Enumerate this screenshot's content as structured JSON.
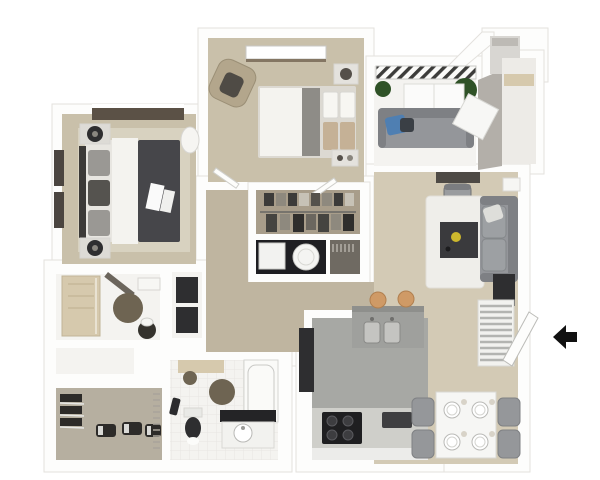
{
  "meta": {
    "type": "3d-floor-plan-rendering",
    "view": "top-down isometric",
    "canvas": {
      "width": 600,
      "height": 480
    },
    "visible_text": "none"
  },
  "colors": {
    "wall": "#fdfdfc",
    "wallEdge": "#e3e1dd",
    "grayWall": "#b3afa9",
    "floorTan": "#c9c0aa",
    "floorTanLight": "#d3cab5",
    "floorHall": "#bfb5a0",
    "floorWhite": "#f4f3f0",
    "floorGray": "#a7a8a4",
    "floorCloset": "#a89d8a",
    "floorShoe": "#b6afa0",
    "dark": "#2e2e30",
    "charcoal": "#46464a",
    "sofa": "#94969a",
    "sofaDark": "#7e8084",
    "fabric": "#f4f3ef",
    "wood": "#d6c9ad",
    "rug": "#6e6452",
    "blue": "#4f7fb2",
    "green": "#2f5227",
    "stool": "#cf9a66",
    "counter": "#9fa09d",
    "counterLight": "#cfcfca",
    "steel": "#c4c4c1",
    "window": "#5b5146",
    "yellow": "#cdb82d",
    "black": "#111111"
  },
  "rooms": [
    {
      "id": "master-bedroom",
      "name": "master bedroom"
    },
    {
      "id": "bedroom-2",
      "name": "second bedroom"
    },
    {
      "id": "balcony",
      "name": "balcony / patio"
    },
    {
      "id": "living-room",
      "name": "living room"
    },
    {
      "id": "dining-area",
      "name": "dining area"
    },
    {
      "id": "kitchen",
      "name": "kitchen"
    },
    {
      "id": "walk-in-closet",
      "name": "walk-in closet with laundry"
    },
    {
      "id": "master-bathroom",
      "name": "master bathroom"
    },
    {
      "id": "bathroom-2",
      "name": "second bathroom"
    },
    {
      "id": "shoe-closet",
      "name": "walk-in shoe closet"
    },
    {
      "id": "linen-closet",
      "name": "linen closet"
    },
    {
      "id": "hallway",
      "name": "hallway"
    },
    {
      "id": "stairs",
      "name": "staircase"
    },
    {
      "id": "entry",
      "name": "entry with open door"
    }
  ],
  "furniture": {
    "master_bedroom": [
      "double-bed",
      "headboard",
      "nightstand-top",
      "nightstand-bottom",
      "table-lamps",
      "area-rug",
      "window-top",
      "windows-left",
      "laundry-basket"
    ],
    "bedroom_2": [
      "double-bed",
      "armchair",
      "nightstand-top-right",
      "nightstand-bottom-right",
      "window-top"
    ],
    "balcony": [
      "railing",
      "outdoor-sofa",
      "blue-pillow",
      "potted-plants",
      "floor-cushions",
      "glass-panel"
    ],
    "living_room": [
      "desk",
      "desk-chair",
      "sofa",
      "coffee-table",
      "yellow-bowl",
      "white-rug",
      "media-console",
      "wall-sconce"
    ],
    "dining_area": [
      "square-table",
      "plates",
      "cups",
      "chairs-x4"
    ],
    "kitchen": [
      "bar-counter",
      "double-sink",
      "bar-stools-x2",
      "refrigerator",
      "range-stove",
      "countertop",
      "counter-appliance"
    ],
    "walk_in_closet": [
      "clothes-rod",
      "hanging-clothes",
      "washer",
      "dryer",
      "side-closet"
    ],
    "master_bathroom": [
      "shower",
      "round-rug",
      "toilet",
      "vanity",
      "door-leaf"
    ],
    "bathroom_2": [
      "bathtub",
      "toilet",
      "vanity-sink",
      "round-rugs",
      "bath-mat",
      "towel"
    ],
    "shoe_closet": [
      "shoe-rack",
      "shoes",
      "hanger-rod"
    ],
    "linen_closet": [
      "storage-bins"
    ],
    "stairs": [
      "treads"
    ],
    "entry": [
      "open-door-leaf",
      "entry-arrow"
    ]
  },
  "entry": {
    "marker": "arrow",
    "direction": "left"
  }
}
